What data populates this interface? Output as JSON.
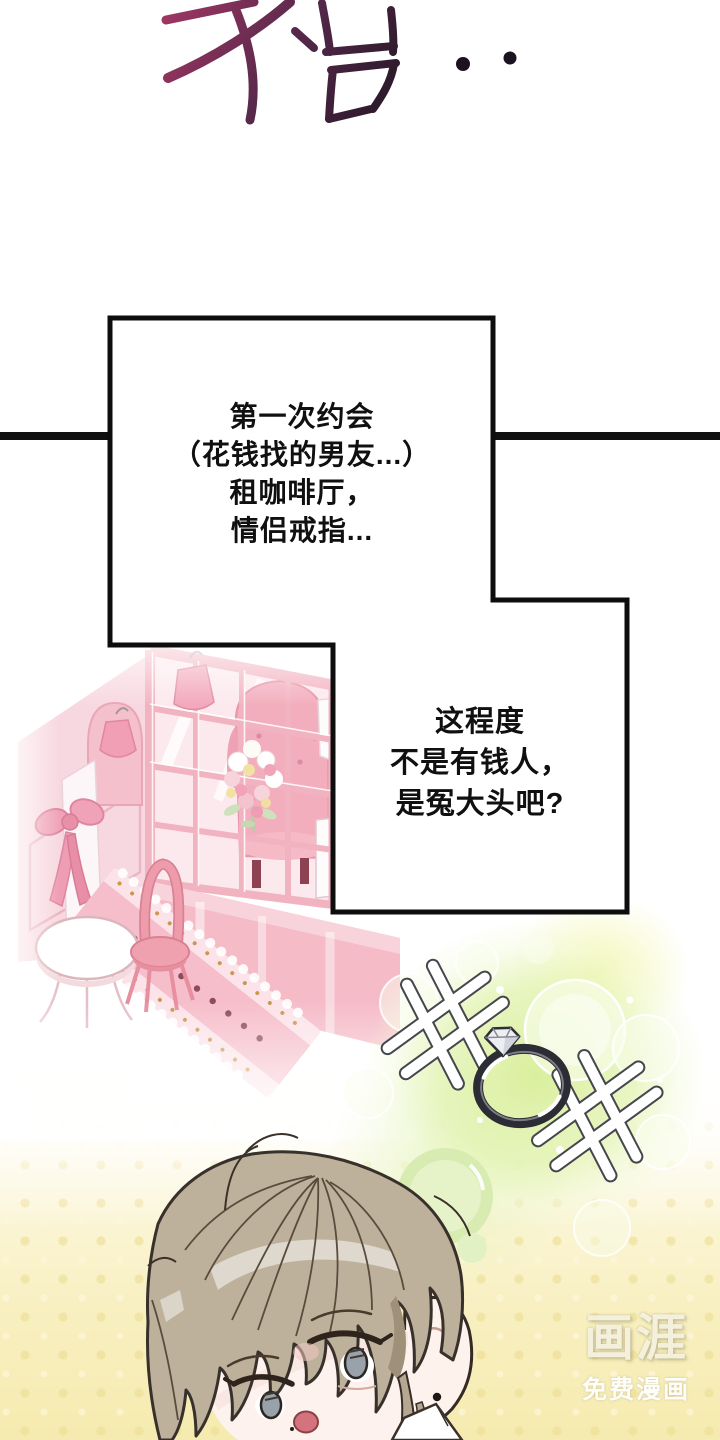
{
  "page_type": "webtoon-comic-panel",
  "sfx": {
    "text": "수습..",
    "color_from": "#9d3663",
    "color_to": "#241724"
  },
  "panel": {
    "divider_color": "#101010"
  },
  "speech": {
    "box_fill": "#ffffff",
    "box_border": "#0d0d0d",
    "text_color": "#101010",
    "box1": "第一次约会\n（花钱找的男友...）\n租咖啡厅，\n情侣戒指...",
    "box2": "这程度\n不是有钱人，\n是冤大头吧?"
  },
  "watermark": {
    "brand": "画涯",
    "tagline": "免费漫画"
  },
  "scene": {
    "cafe_pink": "#f2b1c0",
    "cafe_pink_light": "#fce9ee",
    "glow_green": "#d8ee98",
    "glow_yellow": "#f2f5a5",
    "background_yellow": "#f8efbf",
    "ring_band": "#2c2c34",
    "diamond": "#eceef2",
    "hair_color": "#bdb19c",
    "skin_color": "#fdf2ed",
    "eye_color": "#99a1aa",
    "mouth_color": "#d4737d"
  }
}
